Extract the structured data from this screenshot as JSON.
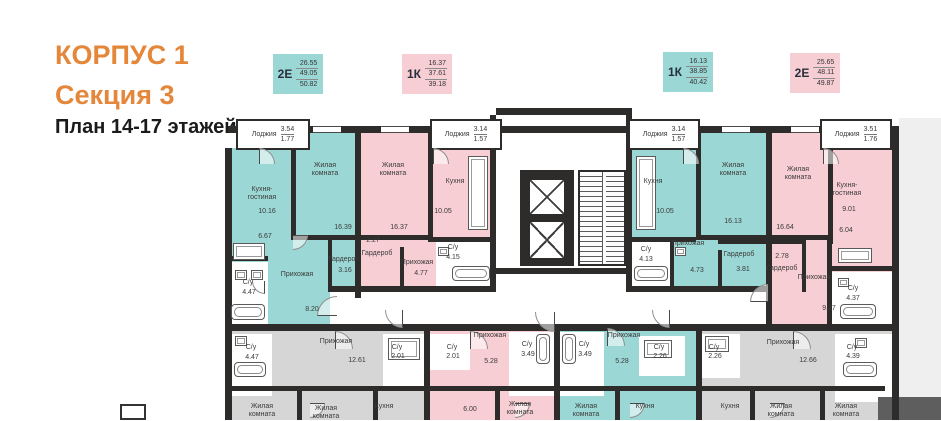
{
  "header": {
    "building": "КОРПУС 1",
    "section": "Секция 3",
    "plan": "План 14-17 этажей"
  },
  "colors": {
    "orange": "#E5873A",
    "teal": "#9BD8D5",
    "pink": "#F8CED5",
    "gray": "#D6D6D6",
    "white": "#FFFFFF",
    "dim": "#5E5E5E",
    "exterior": "#EFEFEF",
    "wall": "#2E2C2B"
  },
  "apartment_cards": [
    {
      "type": "2Е",
      "areas": [
        "26.55",
        "49.05",
        "50.82"
      ],
      "color": "teal",
      "x": 273,
      "y": 54
    },
    {
      "type": "1К",
      "areas": [
        "16.37",
        "37.61",
        "39.18"
      ],
      "color": "pink",
      "x": 402,
      "y": 54
    },
    {
      "type": "1К",
      "areas": [
        "16.13",
        "38.85",
        "40.42"
      ],
      "color": "teal",
      "x": 663,
      "y": 52
    },
    {
      "type": "2Е",
      "areas": [
        "25.65",
        "48.11",
        "49.87"
      ],
      "color": "pink",
      "x": 790,
      "y": 53
    }
  ],
  "floor_plan": {
    "regions": [
      {
        "x": 674,
        "y": 10,
        "w": 42,
        "h": 302,
        "c": "exterior",
        "n": "exterior-strip",
        "i": false
      },
      {
        "x": 5,
        "y": 40,
        "w": 125,
        "h": 176,
        "c": "teal",
        "n": "apartment-2e-left",
        "i": true
      },
      {
        "x": 68,
        "y": 24,
        "w": 62,
        "h": 16,
        "c": "teal",
        "n": "apartment-2e-left",
        "i": true
      },
      {
        "x": 103,
        "y": 132,
        "w": 30,
        "h": 48,
        "c": "teal",
        "n": "apartment-2e-left-wardrobe",
        "i": true
      },
      {
        "x": 135,
        "y": 24,
        "w": 74,
        "h": 115,
        "c": "pink",
        "n": "apartment-1k-left",
        "i": true
      },
      {
        "x": 135,
        "y": 139,
        "w": 76,
        "h": 45,
        "c": "pink",
        "n": "apartment-1k-left",
        "i": true
      },
      {
        "x": 203,
        "y": 40,
        "w": 66,
        "h": 104,
        "c": "pink",
        "n": "apartment-1k-left-kitchen",
        "i": true
      },
      {
        "x": 271,
        "y": 5,
        "w": 130,
        "h": 218,
        "c": "white",
        "n": "core-lobby",
        "i": false
      },
      {
        "x": 407,
        "y": 40,
        "w": 66,
        "h": 104,
        "c": "teal",
        "n": "apartment-1k-right-kitchen",
        "i": true
      },
      {
        "x": 473,
        "y": 24,
        "w": 70,
        "h": 121,
        "c": "teal",
        "n": "apartment-1k-right",
        "i": true
      },
      {
        "x": 407,
        "y": 140,
        "w": 136,
        "h": 44,
        "c": "teal",
        "n": "apartment-1k-right",
        "i": true
      },
      {
        "x": 545,
        "y": 24,
        "w": 60,
        "h": 108,
        "c": "pink",
        "n": "apartment-2e-right-bedroom",
        "i": true
      },
      {
        "x": 547,
        "y": 40,
        "w": 125,
        "h": 178,
        "c": "pink",
        "n": "apartment-2e-right",
        "i": true
      },
      {
        "x": 211,
        "y": 134,
        "w": 56,
        "h": 48,
        "c": "white",
        "n": "bathroom-area",
        "i": false
      },
      {
        "x": 407,
        "y": 134,
        "w": 38,
        "h": 48,
        "c": "white",
        "n": "bathroom-area",
        "i": false
      },
      {
        "x": 607,
        "y": 164,
        "w": 65,
        "h": 52,
        "c": "white",
        "n": "bathroom-area",
        "i": false
      },
      {
        "x": 5,
        "y": 154,
        "w": 38,
        "h": 62,
        "c": "white",
        "n": "bathroom-area",
        "i": false
      },
      {
        "x": 105,
        "y": 184,
        "w": 436,
        "h": 32,
        "c": "white",
        "n": "corridor",
        "i": false
      },
      {
        "x": 0,
        "y": 222,
        "w": 199,
        "h": 90,
        "c": "gray",
        "n": "apartment-lower-left-dimmed",
        "i": true
      },
      {
        "x": 205,
        "y": 222,
        "w": 124,
        "h": 90,
        "c": "pink",
        "n": "apartment-lower-pink",
        "i": true
      },
      {
        "x": 335,
        "y": 222,
        "w": 136,
        "h": 90,
        "c": "teal",
        "n": "apartment-lower-teal",
        "i": true
      },
      {
        "x": 477,
        "y": 222,
        "w": 197,
        "h": 90,
        "c": "gray",
        "n": "apartment-lower-right-dimmed",
        "i": true
      },
      {
        "x": 7,
        "y": 226,
        "w": 40,
        "h": 62,
        "c": "white",
        "n": "bathroom-area",
        "i": false
      },
      {
        "x": 158,
        "y": 226,
        "w": 44,
        "h": 54,
        "c": "white",
        "n": "bathroom-area",
        "i": false
      },
      {
        "x": 205,
        "y": 226,
        "w": 40,
        "h": 36,
        "c": "white",
        "n": "bathroom-area",
        "i": false
      },
      {
        "x": 284,
        "y": 224,
        "w": 45,
        "h": 64,
        "c": "white",
        "n": "bathroom-area",
        "i": false
      },
      {
        "x": 335,
        "y": 224,
        "w": 44,
        "h": 64,
        "c": "white",
        "n": "bathroom-area",
        "i": false
      },
      {
        "x": 414,
        "y": 228,
        "w": 46,
        "h": 40,
        "c": "white",
        "n": "bathroom-area",
        "i": false
      },
      {
        "x": 477,
        "y": 226,
        "w": 38,
        "h": 44,
        "c": "white",
        "n": "bathroom-area",
        "i": false
      },
      {
        "x": 610,
        "y": 226,
        "w": 62,
        "h": 68,
        "c": "white",
        "n": "bathroom-area",
        "i": false
      },
      {
        "x": 653,
        "y": 289,
        "w": 63,
        "h": 23,
        "c": "dim",
        "n": "dimmed-overlay",
        "i": false
      }
    ],
    "walls": [
      [
        3,
        18,
        670,
        7
      ],
      [
        271,
        0,
        136,
        7
      ],
      [
        0,
        40,
        7,
        272
      ],
      [
        667,
        18,
        7,
        294
      ],
      [
        0,
        216,
        674,
        7
      ],
      [
        66,
        24,
        5,
        108
      ],
      [
        66,
        127,
        70,
        5
      ],
      [
        130,
        24,
        6,
        166
      ],
      [
        203,
        24,
        5,
        108
      ],
      [
        135,
        127,
        68,
        5
      ],
      [
        203,
        129,
        64,
        5
      ],
      [
        265,
        7,
        6,
        177
      ],
      [
        401,
        7,
        6,
        177
      ],
      [
        271,
        160,
        136,
        6
      ],
      [
        105,
        178,
        160,
        6
      ],
      [
        407,
        178,
        134,
        6
      ],
      [
        541,
        24,
        6,
        192
      ],
      [
        471,
        24,
        5,
        108
      ],
      [
        473,
        127,
        70,
        5
      ],
      [
        407,
        129,
        64,
        5
      ],
      [
        603,
        24,
        5,
        112
      ],
      [
        545,
        127,
        58,
        5
      ],
      [
        607,
        158,
        65,
        5
      ],
      [
        602,
        132,
        5,
        84
      ],
      [
        5,
        148,
        38,
        5
      ],
      [
        103,
        128,
        32,
        4
      ],
      [
        103,
        128,
        4,
        56
      ],
      [
        103,
        180,
        32,
        4
      ],
      [
        175,
        139,
        4,
        45
      ],
      [
        445,
        134,
        4,
        50
      ],
      [
        493,
        132,
        50,
        4
      ],
      [
        493,
        142,
        4,
        42
      ],
      [
        547,
        132,
        30,
        4
      ],
      [
        577,
        132,
        4,
        52
      ],
      [
        199,
        222,
        6,
        90
      ],
      [
        329,
        222,
        6,
        90
      ],
      [
        471,
        222,
        6,
        90
      ],
      [
        5,
        278,
        655,
        5
      ],
      [
        72,
        278,
        5,
        34
      ],
      [
        148,
        278,
        5,
        34
      ],
      [
        270,
        278,
        5,
        34
      ],
      [
        390,
        278,
        5,
        34
      ],
      [
        525,
        278,
        5,
        34
      ],
      [
        595,
        278,
        5,
        34
      ],
      [
        295,
        62,
        54,
        96
      ]
    ],
    "windows": [
      [
        88,
        18,
        28
      ],
      [
        156,
        18,
        28
      ],
      [
        497,
        18,
        28
      ],
      [
        566,
        18,
        28
      ]
    ],
    "loggias": [
      {
        "x": 11,
        "y": 11,
        "w": 74,
        "h": 31,
        "label": "Лоджия",
        "v1": "3.54",
        "v2": "1.77"
      },
      {
        "x": 205,
        "y": 11,
        "w": 72,
        "h": 31,
        "label": "Лоджия",
        "v1": "3.14",
        "v2": "1.57"
      },
      {
        "x": 403,
        "y": 11,
        "w": 72,
        "h": 31,
        "label": "Лоджия",
        "v1": "3.14",
        "v2": "1.57"
      },
      {
        "x": 595,
        "y": 11,
        "w": 72,
        "h": 31,
        "label": "Лоджия",
        "v1": "3.51",
        "v2": "1.76"
      }
    ],
    "elevators": [
      {
        "x": 303,
        "y": 70,
        "w": 38,
        "h": 38
      },
      {
        "x": 303,
        "y": 112,
        "w": 38,
        "h": 40
      }
    ],
    "stairs": {
      "x": 353,
      "y": 62,
      "w": 48,
      "h": 96
    },
    "fixtures": [
      {
        "t": "stove",
        "x": 8,
        "y": 135,
        "w": 32,
        "h": 17
      },
      {
        "t": "bathtub",
        "x": 6,
        "y": 196,
        "w": 34,
        "h": 16
      },
      {
        "t": "toilet",
        "x": 10,
        "y": 162,
        "w": 12,
        "h": 10
      },
      {
        "t": "sink",
        "x": 26,
        "y": 162,
        "w": 12,
        "h": 10
      },
      {
        "t": "counter",
        "x": 243,
        "y": 48,
        "w": 20,
        "h": 74
      },
      {
        "t": "bathtub",
        "x": 227,
        "y": 158,
        "w": 38,
        "h": 15
      },
      {
        "t": "toilet",
        "x": 213,
        "y": 139,
        "w": 11,
        "h": 9
      },
      {
        "t": "counter",
        "x": 411,
        "y": 48,
        "w": 20,
        "h": 74
      },
      {
        "t": "bathtub",
        "x": 409,
        "y": 158,
        "w": 34,
        "h": 15
      },
      {
        "t": "toilet",
        "x": 450,
        "y": 139,
        "w": 11,
        "h": 9
      },
      {
        "t": "counter",
        "x": 613,
        "y": 140,
        "w": 34,
        "h": 15
      },
      {
        "t": "bathtub",
        "x": 615,
        "y": 196,
        "w": 36,
        "h": 15
      },
      {
        "t": "sink",
        "x": 613,
        "y": 170,
        "w": 11,
        "h": 9
      },
      {
        "t": "bathtub",
        "x": 9,
        "y": 254,
        "w": 32,
        "h": 15
      },
      {
        "t": "sink",
        "x": 10,
        "y": 228,
        "w": 12,
        "h": 10
      },
      {
        "t": "counter",
        "x": 163,
        "y": 230,
        "w": 32,
        "h": 22
      },
      {
        "t": "bathtub",
        "x": 311,
        "y": 226,
        "w": 14,
        "h": 30
      },
      {
        "t": "bathtub",
        "x": 337,
        "y": 226,
        "w": 14,
        "h": 30
      },
      {
        "t": "counter",
        "x": 419,
        "y": 232,
        "w": 28,
        "h": 18
      },
      {
        "t": "counter",
        "x": 480,
        "y": 228,
        "w": 24,
        "h": 16
      },
      {
        "t": "bathtub",
        "x": 618,
        "y": 254,
        "w": 34,
        "h": 15
      },
      {
        "t": "sink",
        "x": 630,
        "y": 230,
        "w": 12,
        "h": 10
      }
    ],
    "doors": [
      {
        "x": 34,
        "y": 40,
        "r": 16,
        "a": 0
      },
      {
        "x": 208,
        "y": 40,
        "r": 16,
        "a": 0
      },
      {
        "x": 458,
        "y": 40,
        "r": 16,
        "a": 0
      },
      {
        "x": 598,
        "y": 40,
        "r": 16,
        "a": 0
      },
      {
        "x": 68,
        "y": 112,
        "r": 15,
        "a": 90
      },
      {
        "x": 40,
        "y": 160,
        "r": 13,
        "a": 180
      },
      {
        "x": 178,
        "y": 184,
        "r": 18,
        "a": 180
      },
      {
        "x": 445,
        "y": 184,
        "r": 18,
        "a": 180
      },
      {
        "x": 543,
        "y": 176,
        "r": 18,
        "a": 270
      },
      {
        "x": 330,
        "y": 184,
        "r": 20,
        "a": 180
      },
      {
        "x": 112,
        "y": 188,
        "r": 20,
        "a": 270
      },
      {
        "x": 110,
        "y": 223,
        "r": 18,
        "a": 0
      },
      {
        "x": 245,
        "y": 223,
        "r": 18,
        "a": 0
      },
      {
        "x": 382,
        "y": 220,
        "r": 18,
        "a": 0
      },
      {
        "x": 568,
        "y": 223,
        "r": 18,
        "a": 0
      },
      {
        "x": 85,
        "y": 280,
        "r": 15,
        "a": 90
      },
      {
        "x": 290,
        "y": 280,
        "r": 15,
        "a": 90
      },
      {
        "x": 405,
        "y": 280,
        "r": 15,
        "a": 90
      },
      {
        "x": 545,
        "y": 280,
        "r": 15,
        "a": 90
      }
    ],
    "labels": [
      {
        "t": "Кухня-\nгостиная",
        "x": 37,
        "y": 86
      },
      {
        "t": "10.16",
        "x": 42,
        "y": 104
      },
      {
        "t": "6.67",
        "x": 40,
        "y": 129
      },
      {
        "t": "Жилая\nкомната",
        "x": 100,
        "y": 62
      },
      {
        "t": "16.39",
        "x": 118,
        "y": 120
      },
      {
        "t": "Гардероб",
        "x": 119,
        "y": 152
      },
      {
        "t": "3.16",
        "x": 120,
        "y": 163
      },
      {
        "t": "Прихожая",
        "x": 72,
        "y": 167
      },
      {
        "t": "8.20",
        "x": 87,
        "y": 202
      },
      {
        "t": "С/у",
        "x": 23,
        "y": 175
      },
      {
        "t": "4.47",
        "x": 24,
        "y": 185
      },
      {
        "t": "Жилая\nкомната",
        "x": 168,
        "y": 62
      },
      {
        "t": "16.37",
        "x": 174,
        "y": 120
      },
      {
        "t": "2.27",
        "x": 148,
        "y": 133
      },
      {
        "t": "Гардероб",
        "x": 152,
        "y": 146
      },
      {
        "t": "Прихожая",
        "x": 192,
        "y": 155
      },
      {
        "t": "4.77",
        "x": 196,
        "y": 166
      },
      {
        "t": "С/у",
        "x": 228,
        "y": 140
      },
      {
        "t": "4.15",
        "x": 228,
        "y": 150
      },
      {
        "t": "Кухня",
        "x": 230,
        "y": 74
      },
      {
        "t": "10.05",
        "x": 218,
        "y": 104
      },
      {
        "t": "Кухня",
        "x": 428,
        "y": 74
      },
      {
        "t": "10.05",
        "x": 440,
        "y": 104
      },
      {
        "t": "Жилая\nкомната",
        "x": 508,
        "y": 62
      },
      {
        "t": "16.13",
        "x": 508,
        "y": 114
      },
      {
        "t": "С/у",
        "x": 421,
        "y": 142
      },
      {
        "t": "4.13",
        "x": 421,
        "y": 152
      },
      {
        "t": "Прихожая",
        "x": 463,
        "y": 136
      },
      {
        "t": "4.73",
        "x": 472,
        "y": 163
      },
      {
        "t": "Гардероб",
        "x": 514,
        "y": 147
      },
      {
        "t": "3.81",
        "x": 518,
        "y": 162
      },
      {
        "t": "2.78",
        "x": 557,
        "y": 149
      },
      {
        "t": "Гардероб",
        "x": 557,
        "y": 161
      },
      {
        "t": "Жилая\nкомната",
        "x": 573,
        "y": 66
      },
      {
        "t": "16.64",
        "x": 560,
        "y": 120
      },
      {
        "t": "Кухня-\nгостиная",
        "x": 622,
        "y": 82
      },
      {
        "t": "9.01",
        "x": 624,
        "y": 102
      },
      {
        "t": "6.04",
        "x": 621,
        "y": 123
      },
      {
        "t": "Прихожая",
        "x": 589,
        "y": 170
      },
      {
        "t": "9.27",
        "x": 604,
        "y": 201
      },
      {
        "t": "С/у",
        "x": 628,
        "y": 181
      },
      {
        "t": "4.37",
        "x": 628,
        "y": 191
      },
      {
        "t": "С/у",
        "x": 26,
        "y": 240
      },
      {
        "t": "4.47",
        "x": 27,
        "y": 250
      },
      {
        "t": "Прихожая",
        "x": 111,
        "y": 234
      },
      {
        "t": "12.61",
        "x": 132,
        "y": 253
      },
      {
        "t": "Жилая\nкомната",
        "x": 37,
        "y": 303
      },
      {
        "t": "Жилая\nкомната",
        "x": 101,
        "y": 305
      },
      {
        "t": "Кухня",
        "x": 159,
        "y": 299
      },
      {
        "t": "С/у",
        "x": 172,
        "y": 240
      },
      {
        "t": "2.01",
        "x": 173,
        "y": 249
      },
      {
        "t": "С/у",
        "x": 227,
        "y": 240
      },
      {
        "t": "2.01",
        "x": 228,
        "y": 249
      },
      {
        "t": "Прихожая",
        "x": 265,
        "y": 228
      },
      {
        "t": "С/у",
        "x": 302,
        "y": 237
      },
      {
        "t": "3.49",
        "x": 303,
        "y": 247
      },
      {
        "t": "5.28",
        "x": 266,
        "y": 254
      },
      {
        "t": "Жилая\nкомната",
        "x": 295,
        "y": 301
      },
      {
        "t": "6.00",
        "x": 245,
        "y": 302
      },
      {
        "t": "С/у",
        "x": 359,
        "y": 237
      },
      {
        "t": "3.49",
        "x": 360,
        "y": 247
      },
      {
        "t": "Прихожая",
        "x": 399,
        "y": 228
      },
      {
        "t": "5.28",
        "x": 397,
        "y": 254
      },
      {
        "t": "С/у",
        "x": 434,
        "y": 240
      },
      {
        "t": "2.26",
        "x": 435,
        "y": 249
      },
      {
        "t": "Жилая\nкомната",
        "x": 361,
        "y": 303
      },
      {
        "t": "Кухня",
        "x": 420,
        "y": 299
      },
      {
        "t": "С/у",
        "x": 489,
        "y": 240
      },
      {
        "t": "2.26",
        "x": 490,
        "y": 249
      },
      {
        "t": "Прихожая",
        "x": 558,
        "y": 235
      },
      {
        "t": "12.66",
        "x": 583,
        "y": 253
      },
      {
        "t": "С/у",
        "x": 627,
        "y": 240
      },
      {
        "t": "4.39",
        "x": 628,
        "y": 249
      },
      {
        "t": "Кухня",
        "x": 505,
        "y": 299
      },
      {
        "t": "Жилая\nкомната",
        "x": 556,
        "y": 303
      },
      {
        "t": "Жилая\nкомната",
        "x": 621,
        "y": 303
      }
    ]
  }
}
